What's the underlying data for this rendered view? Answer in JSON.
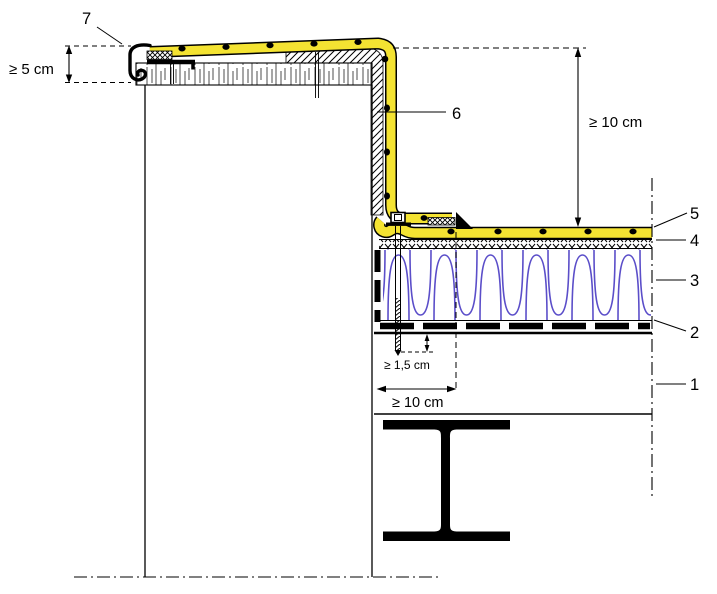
{
  "drawing": {
    "type": "construction-detail-section",
    "background": "#ffffff"
  },
  "callouts": [
    {
      "label": "1"
    },
    {
      "label": "2"
    },
    {
      "label": "3"
    },
    {
      "label": "4"
    },
    {
      "label": "5"
    },
    {
      "label": "6"
    },
    {
      "label": "7"
    }
  ],
  "dimensions": {
    "min_upstand_left": "≥ 5 cm",
    "min_upstand_right": "≥ 10 cm",
    "min_fastener_embedment": "≥ 1,5 cm",
    "min_membrane_overlap": "≥ 10 cm"
  },
  "colors": {
    "membrane_yellow": "#f4e332",
    "insulation_blue": "#5b4ec9",
    "line_black": "#000000"
  }
}
